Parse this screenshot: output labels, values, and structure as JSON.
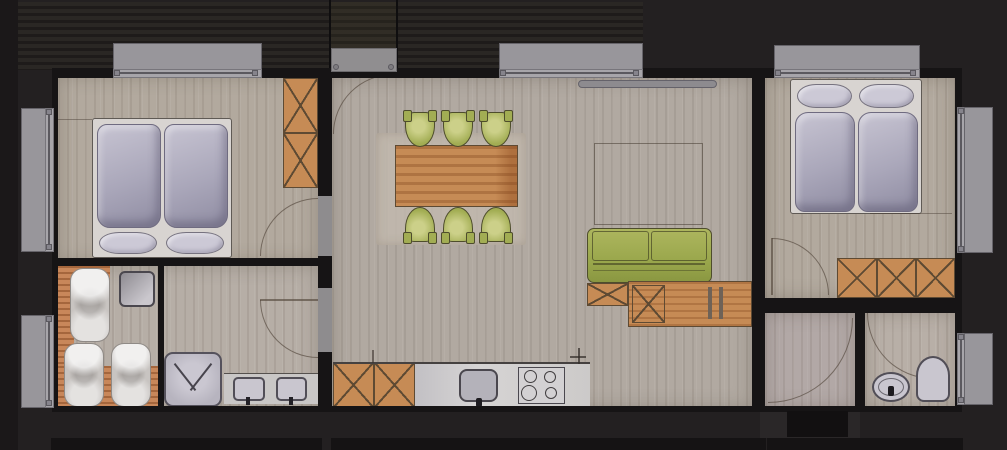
{
  "title": "apartment-floor-plan-rendering",
  "palette": {
    "bg": "#232021",
    "bgEdge": "#1b1819",
    "wall": "#161415",
    "stripeDark": "#1d1a19",
    "stripeLight": "#2b2826",
    "floorWarm": "#b2a99e",
    "floorLiving": "#b1a9a1",
    "floorBath": "#b6aea6",
    "floorGray": "#b2a8a6",
    "floorWc": "#b8afa7",
    "wood": "#c68b55",
    "woodLine": "#5e4a33",
    "green": "#a2ad53",
    "greenDark": "#4e4d2c",
    "frameWhite": "#d8d4d1",
    "windowGray": "#98969b",
    "windowFrame": "#66646a",
    "windowLine": "#5b595f",
    "tileOrange": "#c8875a",
    "tileLine": "rgba(141,80,41,0.6)",
    "fixtureGray": "#c9c6cf",
    "fixtureLine": "#514e57",
    "counterGray": "#c9c7c6",
    "rug": "#c2b9ae",
    "arcLine": "rgba(84,72,60,0.65)",
    "blackRect": "#121011",
    "bottomRect": "#151314"
  },
  "scene": {
    "type": "watercolor floor plan, top view, dark background",
    "rooms": [
      "bedroom-left",
      "sauna-bathroom",
      "living-dining-kitchen",
      "bedroom-right",
      "vestibule",
      "wc"
    ],
    "furniture": [
      "double-bed-left",
      "wardrobe-left",
      "sauna-loungers",
      "sauna-heater",
      "shower-tray",
      "twin-washbasins",
      "dining-table",
      "six-green-chairs",
      "green-sofa",
      "sideboard",
      "kitchen-cabinets",
      "kitchen-sink",
      "cooktop",
      "double-bed-right",
      "wardrobe-right",
      "toilet",
      "bidet"
    ],
    "windows_count": 7,
    "door_arcs_count": 6
  }
}
